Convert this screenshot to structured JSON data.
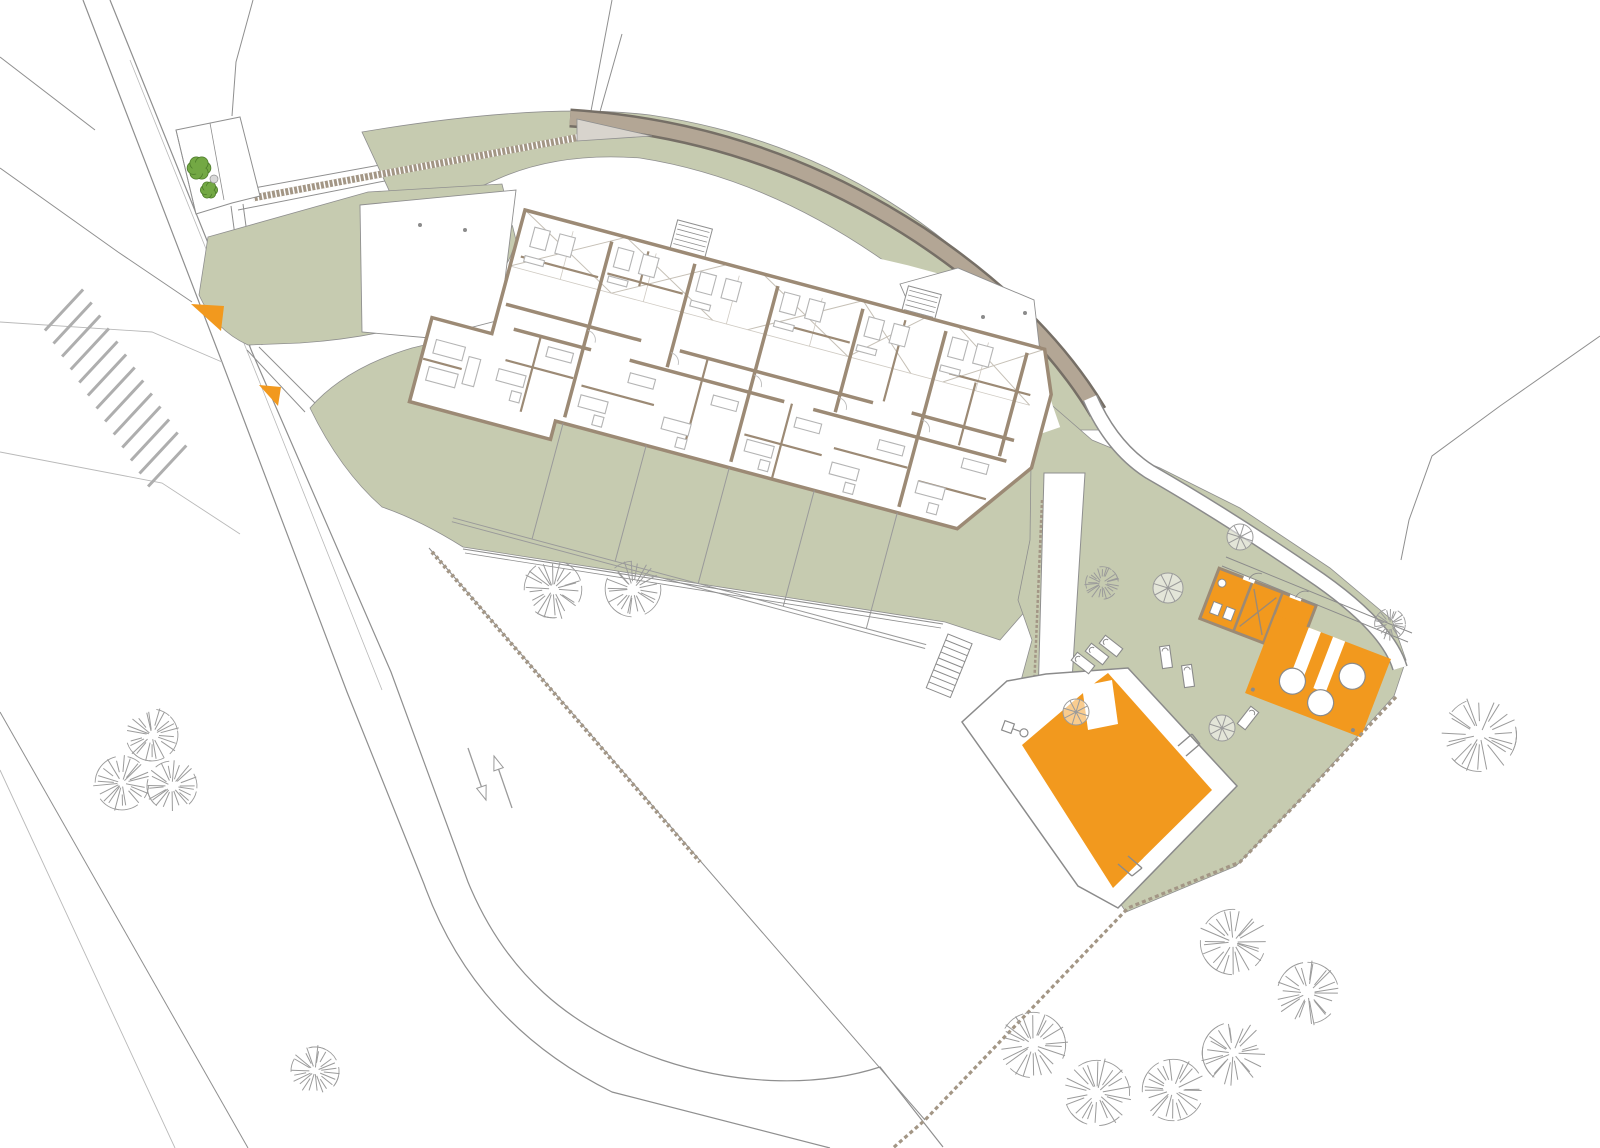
{
  "canvas": {
    "width": 1600,
    "height": 1148,
    "background": "#ffffff"
  },
  "colors": {
    "green": "#c6cbb0",
    "orange": "#f2991e",
    "wall": "#9c8a75",
    "road_band": "#b3a695",
    "band_edge": "#766f66",
    "line": "#8f8f8f",
    "faint": "#b9b9b9",
    "furniture": "#b4b4b4",
    "tree": "#9b9b9b",
    "bush_fill": "#73a844",
    "bush_edge": "#4d7b2b",
    "hatch": "#a39685",
    "deck_edge": "#8b8b8b",
    "roof_hatch": "#c6c0b6",
    "white": "#ffffff"
  },
  "greens": {
    "north_band": "M362,132 Q540,102 650,115 Q820,140 950,245 Q1060,330 1104,430 L1046,430 Q1000,350 910,280 Q780,180 640,158 Q560,152 500,178 L450,200 L400,214 Z",
    "left_wedge": "M208,237 L368,192 L502,184 L516,240 Q505,285 455,312 Q380,338 300,343 L248,345 Q215,330 199,295 Z",
    "lower": "M310,408 Q345,368 412,348 L470,334 L980,428 L1035,470 L1048,585 L1000,640 L945,622 L463,547 Q420,520 382,507 Q340,470 310,408 Z",
    "pool": "M1032,388 L1092,440 L1160,468 L1240,508 L1330,568 L1392,620 L1406,660 L1394,696 L1298,802 L1236,866 L1126,912 L1006,736 L1032,640 L1018,600 L1030,540 Z"
  },
  "site_lines": [
    {
      "d": "M83,0 L222,362 L347,692 L424,884 C458,978 520,1046 612,1092 L830,1148",
      "w": 1.2,
      "k": "line"
    },
    {
      "d": "M110,0 L252,352 L391,672 L468,882 C505,972 568,1028 662,1060 C742,1087 822,1086 880,1067 L943,1147",
      "w": 1.2,
      "k": "line"
    },
    {
      "d": "M130,60 L262,388 L382,690",
      "w": 0.8,
      "k": "faint"
    },
    {
      "d": "M0,57 L95,130",
      "w": 1,
      "k": "line"
    },
    {
      "d": "M0,168 L118,252 L192,302",
      "w": 1,
      "k": "line"
    },
    {
      "d": "M253,0 L236,62 L232,116",
      "w": 1,
      "k": "line"
    },
    {
      "d": "M0,322 L152,332 L222,362",
      "w": 0.9,
      "k": "faint"
    },
    {
      "d": "M0,452 L162,483 L240,534",
      "w": 0.9,
      "k": "faint"
    },
    {
      "d": "M0,712 L248,1148",
      "w": 1,
      "k": "line"
    },
    {
      "d": "M0,770 L175,1148",
      "w": 0.9,
      "k": "faint"
    },
    {
      "d": "M1600,336 L1500,406 L1432,456 L1409,520 L1401,560",
      "w": 1,
      "k": "line"
    },
    {
      "d": "M231,206 L250,347",
      "w": 1,
      "k": "line"
    },
    {
      "d": "M243,204 L262,345",
      "w": 1,
      "k": "line"
    },
    {
      "d": "M247,350 L305,412",
      "w": 1,
      "k": "line"
    },
    {
      "d": "M259,347 L316,404",
      "w": 1,
      "k": "line"
    },
    {
      "d": "M612,0 L588,127 L232,192",
      "w": 1,
      "k": "line"
    },
    {
      "d": "M622,34 L592,140 L238,210",
      "w": 1,
      "k": "line"
    }
  ],
  "road_band": {
    "d": "M570,118 Q760,130 920,235 Q1040,315 1098,412",
    "outer_w": 19,
    "inner_w": 14
  },
  "path_curve": {
    "d": "M1090,398 Q1112,448 1150,472 Q1230,518 1320,580 Q1388,628 1400,668",
    "outer_w": 16,
    "inner_w": 13
  },
  "top_path_hatch": {
    "d": "M253,198 L586,136",
    "w": 7
  },
  "gray_triangle": "M577,119 L652,136 L577,141 Z",
  "court": {
    "outline": "M176,130 L240,117 L260,196 L232,203 L196,214 Z",
    "inner_lines": [
      "M210,123 L224,200",
      "M196,214 L176,130"
    ],
    "bushes": [
      [
        199,
        168,
        11
      ],
      [
        209,
        190,
        8
      ]
    ],
    "pebble": [
      214,
      179,
      4
    ]
  },
  "forecourt": {
    "poly": "M360,205 L516,190 L500,320 L430,338 L362,332 Z",
    "dots": [
      [
        420,
        225
      ],
      [
        465,
        230
      ]
    ]
  },
  "ne_terrace": {
    "poly": "M900,284 L958,268 L1034,300 L1040,352 L1020,392 L920,330 Z",
    "dots": [
      [
        983,
        317
      ],
      [
        1025,
        313
      ]
    ]
  },
  "aprons": [
    {
      "d": "M470,208 L700,230 L905,278 L1005,305",
      "w": 26
    },
    {
      "d": "M1002,305 L1046,432",
      "w": 30
    },
    {
      "d": "M476,208 L428,330",
      "w": 22
    }
  ],
  "building": {
    "pivot": [
      525,
      210
    ],
    "angle": 15,
    "envelope": "M0,0 L538,0 L556,42 L556,118 L500,196 L84,196 L84,215 L-62,215 L-62,128 L0,128 Z",
    "stair_cores": [
      [
        150,
        -30,
        36,
        30
      ],
      [
        390,
        -26,
        34,
        26
      ]
    ],
    "roof_cells": [
      [
        0,
        105
      ],
      [
        105,
        210
      ],
      [
        246,
        350
      ],
      [
        350,
        415
      ],
      [
        448,
        538
      ]
    ],
    "roof_band_y": 58,
    "walls_major": [
      "M6,96 H146",
      "M186,96 H386",
      "M426,96 H532",
      "M20,118 H100",
      "M140,118 H300",
      "M330,118 H530",
      "M92,8 V190",
      "M178,8 V115",
      "M264,8 V190",
      "M352,8 V115",
      "M438,8 V190",
      "M522,8 V115"
    ],
    "walls_minor": [
      "M8,46 H88",
      "M96,40 H174",
      "M130,8 V44",
      "M20,150 H90",
      "M48,118 V196",
      "M100,155 H175",
      "M215,96 V190",
      "M270,160 H350",
      "M308,118 V196",
      "M270,44 H348",
      "M396,8 V92",
      "M360,150 H436",
      "M452,48 H536",
      "M480,50 V115",
      "M450,160 H520",
      "M-60,170 H-20"
    ],
    "light_lines": [
      "M0,58 H538",
      "M52,8 V58",
      "M138,8 V58",
      "M224,8 V58",
      "M310,8 V58",
      "M396,8 V58",
      "M482,8 V58"
    ],
    "furniture": [
      [
        14,
        14,
        16,
        20
      ],
      [
        40,
        14,
        16,
        20
      ],
      [
        100,
        12,
        16,
        20
      ],
      [
        126,
        12,
        16,
        20
      ],
      [
        186,
        14,
        16,
        20
      ],
      [
        212,
        14,
        16,
        20
      ],
      [
        272,
        12,
        16,
        20
      ],
      [
        298,
        12,
        16,
        20
      ],
      [
        360,
        14,
        16,
        20
      ],
      [
        386,
        14,
        16,
        20
      ],
      [
        446,
        12,
        16,
        20
      ],
      [
        472,
        12,
        16,
        20
      ],
      [
        12,
        44,
        20,
        6
      ],
      [
        98,
        42,
        20,
        6
      ],
      [
        184,
        44,
        20,
        6
      ],
      [
        270,
        42,
        20,
        6
      ],
      [
        356,
        44,
        20,
        6
      ],
      [
        442,
        42,
        20,
        6
      ],
      [
        58,
        126,
        26,
        10
      ],
      [
        144,
        130,
        26,
        10
      ],
      [
        230,
        130,
        26,
        10
      ],
      [
        316,
        130,
        26,
        10
      ],
      [
        402,
        130,
        26,
        10
      ],
      [
        488,
        126,
        26,
        10
      ],
      [
        16,
        160,
        28,
        12
      ],
      [
        102,
        164,
        28,
        12
      ],
      [
        188,
        164,
        28,
        12
      ],
      [
        274,
        164,
        28,
        12
      ],
      [
        362,
        164,
        28,
        12
      ],
      [
        450,
        160,
        28,
        12
      ],
      [
        34,
        178,
        10,
        10
      ],
      [
        120,
        180,
        10,
        10
      ],
      [
        206,
        180,
        10,
        10
      ],
      [
        292,
        180,
        10,
        10
      ],
      [
        380,
        180,
        10,
        10
      ],
      [
        466,
        178,
        10,
        10
      ],
      [
        -52,
        148,
        30,
        14
      ],
      [
        -52,
        176,
        30,
        14
      ],
      [
        -16,
        156,
        12,
        28
      ]
    ],
    "door_arcs": [
      [
        92,
        100
      ],
      [
        178,
        100
      ],
      [
        264,
        100
      ],
      [
        352,
        100
      ],
      [
        438,
        100
      ]
    ],
    "terrace_lines": [
      "M10,316 H500",
      "M10,320 H500"
    ],
    "terrace_dividers": [
      92,
      178,
      264,
      352,
      438
    ],
    "terrace_div_y": [
      196,
      316
    ]
  },
  "pool": {
    "deck": "M1007,681 L1046,674 L1128,668 L1237,786 L1118,908 L1078,886 L962,722 Z",
    "water": "M1022,745 L1096,682 L1108,673 L1212,790 L1113,888 Z",
    "notch": "M1082,686 L1112,680 L1118,724 L1088,730 Z",
    "ladders": [
      [
        "M1178,746 L1192,734",
        "M1186,756 L1200,744",
        "M1192,734 L1200,744"
      ],
      [
        "M1128,856 L1142,868",
        "M1118,864 L1132,876",
        "M1142,868 L1132,876"
      ]
    ],
    "stairs": {
      "x": 948,
      "y": 634,
      "angle": 22,
      "w": 26,
      "h": 58,
      "steps": 9
    },
    "shower": {
      "x": 1008,
      "y": 727,
      "angle": 20
    }
  },
  "changing_rooms": {
    "pivot": [
      1258,
      612
    ],
    "angle": 21,
    "w": 104,
    "h": 54,
    "partitions": [
      -16,
      16
    ],
    "fixtures": [
      [
        -45,
        6,
        9,
        12
      ],
      [
        -31,
        6,
        9,
        12
      ]
    ],
    "basin": [
      -44,
      -14,
      4
    ],
    "brace": "M-12,-20 L12,20 M-12,20 L12,-20",
    "gaps": [
      [
        -26,
        -29,
        12,
        4
      ],
      [
        24,
        -29,
        12,
        4
      ]
    ]
  },
  "pool_bar_terrace": {
    "pivot": [
      1318,
      676
    ],
    "angle": 21,
    "w": 124,
    "h": 84,
    "stripes": [
      [
        -26,
        -42,
        13,
        62
      ],
      [
        0,
        -42,
        13,
        55
      ]
    ],
    "circles": [
      [
        32,
        -12,
        13
      ],
      [
        -22,
        14,
        13
      ],
      [
        12,
        24,
        13
      ]
    ],
    "dots": [
      [
        -56,
        36
      ],
      [
        52,
        38
      ]
    ]
  },
  "walkway_lines": [
    "M1222,566 L1408,642",
    "M1226,557 L1412,633"
  ],
  "ramp": {
    "poly": "M1044,473 L1085,473 L1070,712 L1038,700 Z",
    "dash_edge": "M1042,500 L1034,690"
  },
  "fences": [
    {
      "d": "M1396,697 L1300,800 L1240,862 L1128,908 L925,1120 L893,1148",
      "w": 3.2,
      "dash": "4 3"
    },
    {
      "d": "M429,548 L925,1120",
      "w": 1,
      "dash": ""
    },
    {
      "d": "M432,552 L700,862",
      "w": 4,
      "dash": "3 3"
    },
    {
      "d": "M463,549 L943,624",
      "w": 1.1,
      "dash": ""
    },
    {
      "d": "M465,553 L941,628",
      "w": 0.8,
      "dash": ""
    }
  ],
  "trees": {
    "sketch": [
      [
        553,
        589,
        30
      ],
      [
        633,
        589,
        29
      ],
      [
        152,
        735,
        27
      ],
      [
        122,
        783,
        28
      ],
      [
        172,
        786,
        26
      ],
      [
        315,
        1071,
        25
      ],
      [
        1233,
        942,
        34
      ],
      [
        1308,
        993,
        32
      ],
      [
        1033,
        1045,
        34
      ],
      [
        1233,
        1053,
        32
      ],
      [
        1097,
        1093,
        34
      ],
      [
        1173,
        1090,
        32
      ],
      [
        1480,
        735,
        38
      ],
      [
        1102,
        583,
        17
      ],
      [
        1390,
        624,
        16
      ]
    ],
    "wheel": [
      [
        1168,
        588,
        15
      ],
      [
        1240,
        537,
        13
      ],
      [
        1076,
        712,
        13
      ],
      [
        1222,
        728,
        13
      ]
    ]
  },
  "loungers": [
    [
      1083,
      663,
      -52
    ],
    [
      1097,
      654,
      -52
    ],
    [
      1111,
      646,
      -52
    ],
    [
      1166,
      657,
      -8
    ],
    [
      1188,
      676,
      -8
    ],
    [
      1248,
      718,
      38
    ]
  ],
  "entrance_triangles": [
    [
      [
        191,
        304
      ],
      [
        224,
        306
      ],
      [
        221,
        331
      ]
    ],
    [
      [
        259,
        385
      ],
      [
        281,
        387
      ],
      [
        278,
        406
      ]
    ]
  ],
  "direction_arrows": [
    {
      "tail": [
        512,
        808
      ],
      "head": [
        494,
        756
      ]
    },
    {
      "tail": [
        468,
        748
      ],
      "head": [
        486,
        800
      ]
    }
  ],
  "parking": {
    "x": 64,
    "y": 310,
    "dx": 8.6,
    "dy": 13.0,
    "count": 13,
    "length": 56,
    "angle_deg": -47
  }
}
